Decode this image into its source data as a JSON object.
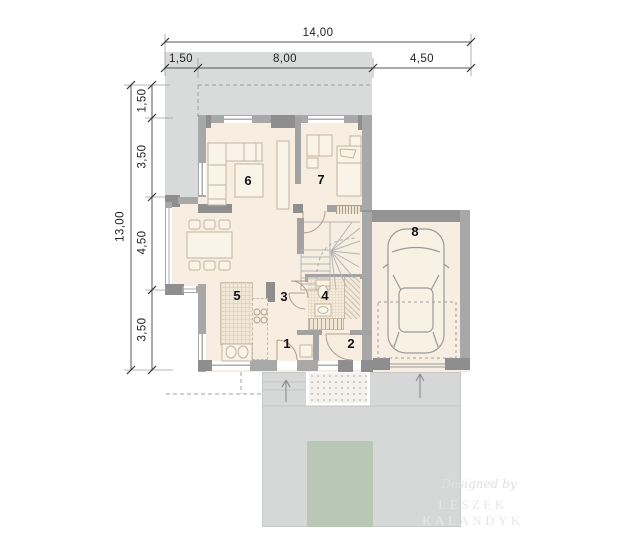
{
  "dimensions_top": {
    "total": "14,00",
    "segments": [
      "1,50",
      "8,00",
      "4,50"
    ]
  },
  "dimensions_left": {
    "total": "13,00",
    "segments": [
      "1,50",
      "3,50",
      "4,50",
      "3,50"
    ]
  },
  "rooms": [
    {
      "number": "1"
    },
    {
      "number": "2"
    },
    {
      "number": "3"
    },
    {
      "number": "4"
    },
    {
      "number": "5"
    },
    {
      "number": "6"
    },
    {
      "number": "7"
    },
    {
      "number": "8"
    }
  ],
  "watermark": {
    "line1": "Designed by",
    "line2": "LESZEK KALANDYK"
  },
  "colors": {
    "terrace": "#d9dbda",
    "driveway": "#d6d8d8",
    "floor": "#f7eee1",
    "wall": "#a8a8a8",
    "wall_dark": "#8e8e8e",
    "lawn": "#b9c8b5",
    "furniture_stroke": "#c2b4a0",
    "label": "#111111"
  }
}
